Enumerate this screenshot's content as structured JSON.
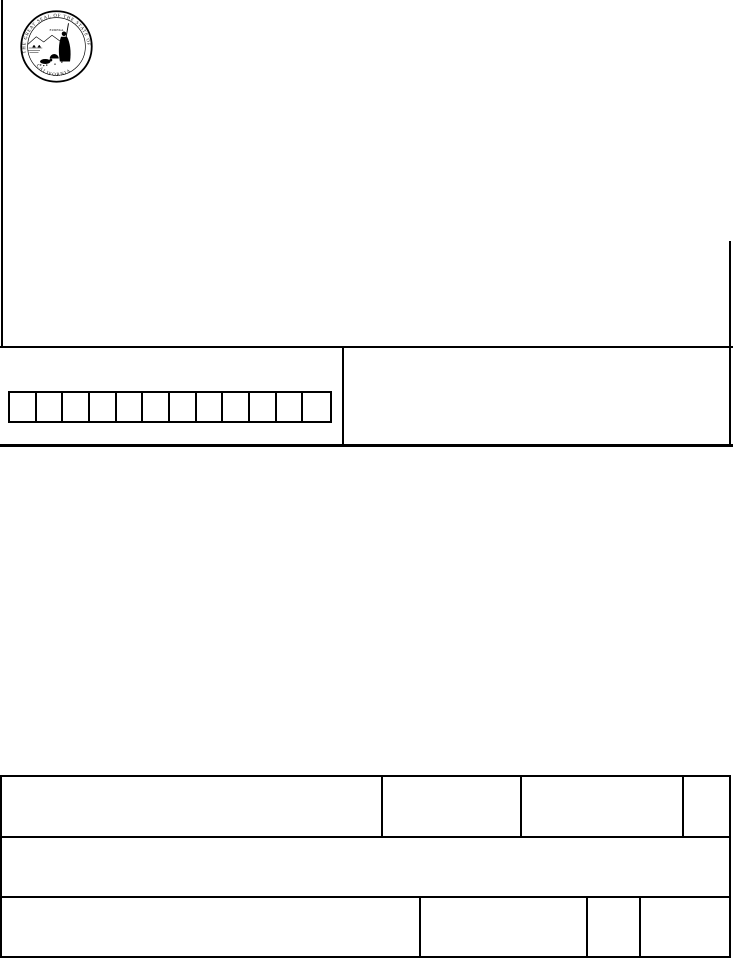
{
  "page": {
    "background_color": "#ffffff",
    "line_color": "#000000",
    "description": "Blank scanned California state form page"
  },
  "seal": {
    "name": "Great Seal of the State of California",
    "rim_text": "THE GREAT SEAL OF THE STATE OF",
    "bottom_text": "CALIFORNIA",
    "motto": "EUREKA"
  },
  "character_grid": {
    "cell_count": 12
  },
  "bottom_table": {
    "row1_cell_count": 4,
    "row2_cell_count": 1,
    "row3_cell_count": 4
  }
}
